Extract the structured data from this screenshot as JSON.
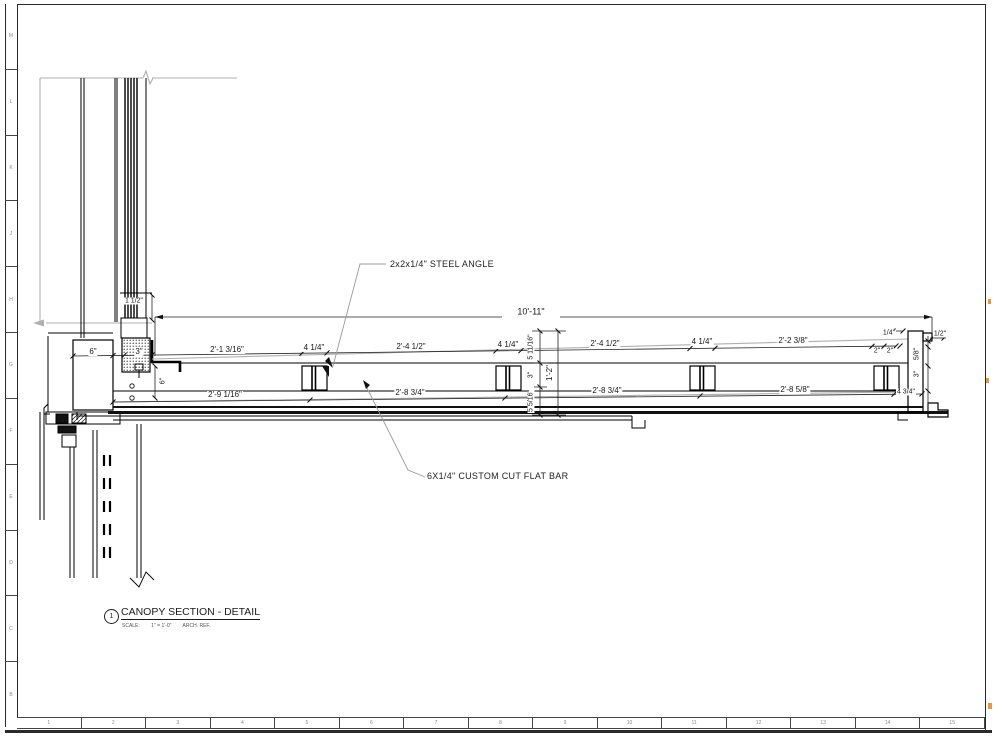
{
  "sheet": {
    "row_labels": [
      "M",
      "L",
      "K",
      "J",
      "H",
      "G",
      "F",
      "E",
      "D",
      "C",
      "B"
    ],
    "col_labels": [
      "1",
      "2",
      "3",
      "4",
      "5",
      "6",
      "7",
      "8",
      "9",
      "10",
      "11",
      "12",
      "13",
      "14",
      "15"
    ]
  },
  "annotations": {
    "steel_angle": "2x2x1/4\" STEEL ANGLE",
    "flat_bar": "6X1/4\" CUSTOM CUT FLAT BAR"
  },
  "titleblock": {
    "detail_number": "1",
    "title": "CANOPY SECTION - DETAIL",
    "scale_label": "SCALE:",
    "scale_value": "1\" = 1'-0\"",
    "ref_label": "ARCH. REF."
  },
  "dims": {
    "overall": "10'-11\"",
    "top": [
      "6\"",
      "3\"",
      "2'-1 3/16\"",
      "4 1/4\"",
      "2'-4 1/2\"",
      "4 1/4\"",
      "2'-4 1/2\"",
      "4 1/4\"",
      "2'-2 3/8\""
    ],
    "bottom": [
      "2'-9 1/16\"",
      "2'-8 3/4\"",
      "2'-8 3/4\"",
      "2'-8 5/8\"",
      "4 3/4\""
    ],
    "mid_vertical": [
      "5 11/16\"",
      "3\"",
      "5 5/16\"",
      "1'-2\""
    ],
    "left": [
      "1 1/2\"",
      "6\""
    ],
    "right_end": [
      "1/4\"",
      "2\"",
      "2\"",
      "5/8\"",
      "1/2\"",
      "3\""
    ]
  },
  "colors": {
    "line": "#1a1a1a",
    "gray": "#b0b0b0",
    "accent_mark": "#e8973a"
  }
}
